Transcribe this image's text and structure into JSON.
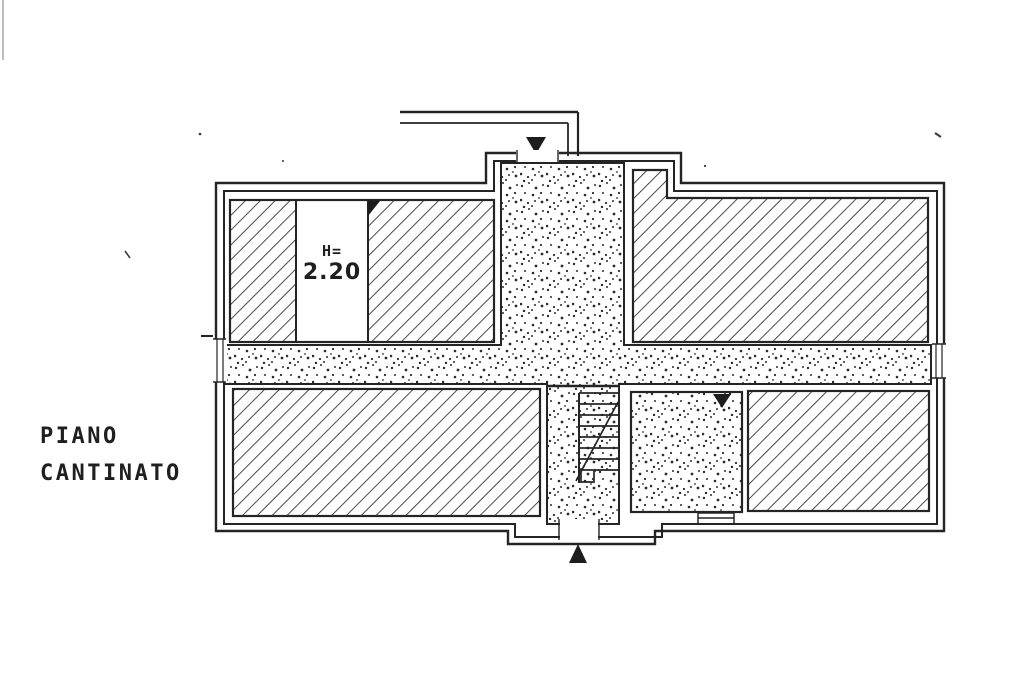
{
  "drawing": {
    "floor_title_line1": "PIANO",
    "floor_title_line2": "CANTINATO",
    "room_height_prefix": "H=",
    "room_height_value": "2.20"
  },
  "markers": {
    "top_entrance_icon": "arrow-down-filled-triangle",
    "bottom_entrance_icon": "arrow-up-filled-triangle",
    "door_swing_icon": "small-filled-triangle",
    "room_marker_icon": "small-filled-triangle"
  },
  "colors": {
    "ink": "#242424",
    "paper": "#ffffff"
  }
}
